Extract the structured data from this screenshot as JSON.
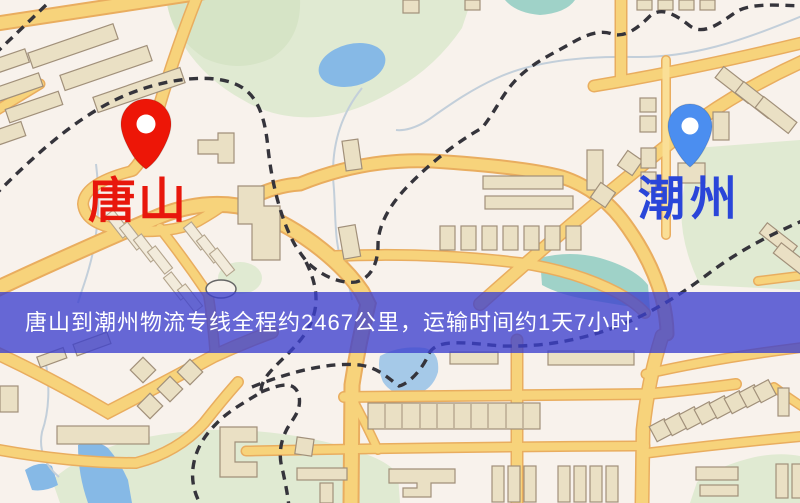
{
  "map": {
    "origin_marker": {
      "label": "唐山",
      "pin_color": "#ed1607",
      "label_color": "#e8170c",
      "icon": "map-pin"
    },
    "destination_marker": {
      "label": "潮州",
      "pin_color": "#4b8ef0",
      "label_color": "#2a46d9",
      "icon": "map-pin"
    },
    "info_banner": {
      "text": "唐山到潮州物流专线全程约2467公里，运输时间约1天7小时.",
      "background_color": "#3c40ce",
      "text_color": "#ffffff"
    },
    "route_facts": {
      "origin": "唐山",
      "destination": "潮州",
      "distance_km": "2467",
      "transit_time": "1天7小时"
    }
  }
}
